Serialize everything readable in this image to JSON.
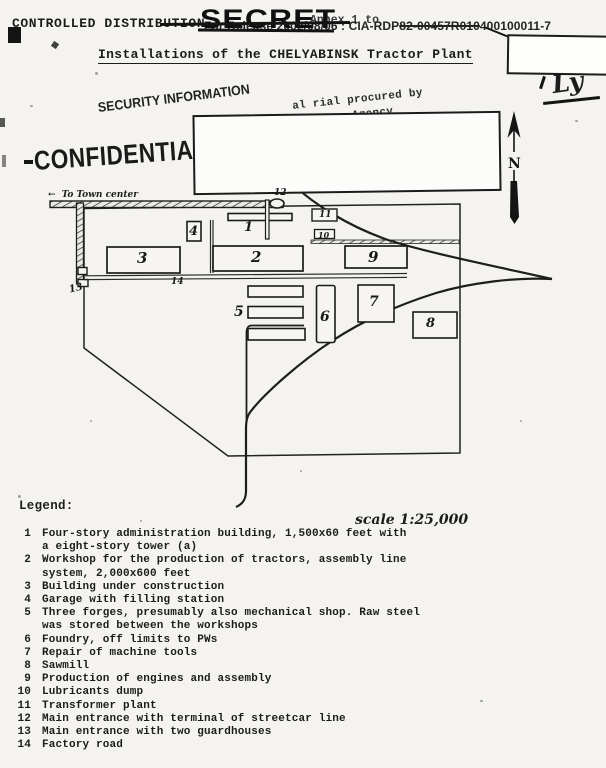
{
  "header": {
    "controlled_distribution": "CONTROLLED DISTRIBUTION",
    "secret_stamp": "SECRET",
    "annex_note": "Annex 1 to",
    "release_pre": "For Release 2002/08/06 : CIA-RDP",
    "release_struck": "82-00457R010",
    "release_post": "400100011-7",
    "title": "Installations of the CHELYABINSK Tractor Plant",
    "handwritten_mark": "Ly"
  },
  "stamps": {
    "security_information": "SECURITY INFORMATION",
    "confidential": "CONFIDENTIAL",
    "procured_line1": "al rial procured by",
    "procured_line2": "Agency"
  },
  "map": {
    "to_town_arrow": "←",
    "to_town_center": "To Town center",
    "north_label": "N",
    "scale_note": "scale 1:25,000",
    "labels": {
      "b1": "1",
      "b2": "2",
      "b3": "3",
      "b4": "4",
      "b5": "5",
      "b6": "6",
      "b7": "7",
      "b8": "8",
      "b9": "9",
      "b10": "10",
      "b11": "11",
      "b12": "12",
      "b13": "13",
      "b14": "14"
    }
  },
  "legend": {
    "heading": "Legend:",
    "items": [
      {
        "num": "1",
        "text": "Four-story administration building, 1,500x60 feet with\na eight-story tower (a)"
      },
      {
        "num": "2",
        "text": "Workshop for the production of tractors, assembly line\nsystem, 2,000x600 feet"
      },
      {
        "num": "3",
        "text": "Building under construction"
      },
      {
        "num": "4",
        "text": "Garage with filling station"
      },
      {
        "num": "5",
        "text": "Three forges, presumably also mechanical shop. Raw steel\nwas stored between the workshops"
      },
      {
        "num": "6",
        "text": "Foundry, off limits to PWs"
      },
      {
        "num": "7",
        "text": "Repair of machine tools"
      },
      {
        "num": "8",
        "text": "Sawmill"
      },
      {
        "num": "9",
        "text": "Production of engines and assembly"
      },
      {
        "num": "10",
        "text": "Lubricants dump"
      },
      {
        "num": "11",
        "text": "Transformer plant"
      },
      {
        "num": "12",
        "text": "Main entrance with terminal of streetcar line"
      },
      {
        "num": "13",
        "text": "Main entrance with two guardhouses"
      },
      {
        "num": "14",
        "text": "Factory road"
      }
    ]
  }
}
